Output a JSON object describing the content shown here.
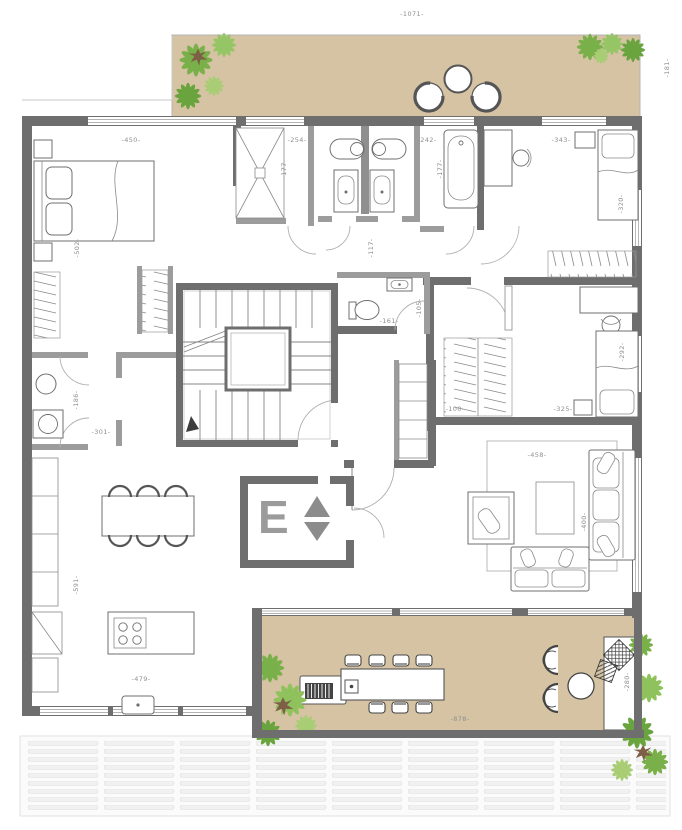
{
  "labels": {
    "top_width": "-1071-",
    "terrace_side": "-181-",
    "master_width": "-450-",
    "master_depth": "-502-",
    "shower_width": "-254-",
    "shower_depth": "-177-",
    "bath_width": "-242-",
    "bath_depth": "-177-",
    "bedroom2_width": "-343-",
    "bedroom2_bed": "-320-",
    "corridor": "-117-",
    "small_wc_width": "-161-",
    "small_wc_depth": "-105-",
    "hall": "-100-",
    "utility_depth": "-186-",
    "utility_width": "-301-",
    "bedroom3_bed": "-292-",
    "bedroom3_width": "-325-",
    "living_rug_width": "-458-",
    "living_rug_depth": "-400-",
    "kitchen_depth": "-591-",
    "kitchen_width": "-479-",
    "terrace_width": "-878-",
    "daybed": "-280-"
  },
  "elevator": {
    "letter": "E"
  },
  "colors": {
    "wall": "#6e6e6e",
    "partition": "#9c9c9c",
    "terrace_floor": "#d5c3a3",
    "label_text": "#8f8f8f",
    "plant_green": "#79b04a",
    "plant_green_light": "#a8cd74",
    "plant_brown": "#7e5f46",
    "deck_slat": "#f1f1f1"
  }
}
